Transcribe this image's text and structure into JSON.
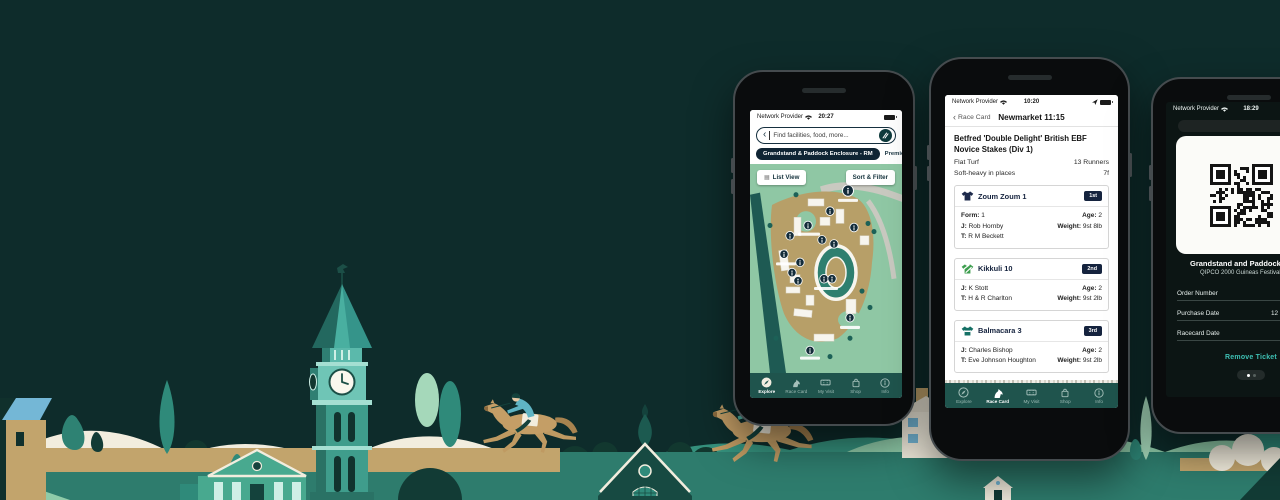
{
  "colors": {
    "sky": "#0E2C2B",
    "nav_bar_teal": "#1F544D",
    "accent_navy": "#15233E",
    "map_green": "#8FC7A4",
    "remove_link_teal": "#3EC0B4",
    "illustration_tan": "#C2A46C",
    "illustration_light_green": "#8FCBA9"
  },
  "nav_labels": [
    "Explore",
    "Race Card",
    "My Visit",
    "Shop",
    "Info"
  ],
  "explore_phone": {
    "carrier": "Network Provider",
    "time": "20:27",
    "search_placeholder": "Find facilities, food, more...",
    "chip_primary": "Grandstand & Paddock Enclosure - RM",
    "chip_secondary": "Premier Enclos",
    "list_view": "List View",
    "sort_filter": "Sort & Filter"
  },
  "racecard_phone": {
    "carrier": "Network Provider",
    "time": "10:20",
    "back": "Race Card",
    "heading": "Newmarket 11:15",
    "race_name": "Betfred 'Double Delight' British EBF Novice Stakes (Div 1)",
    "surface": "Flat Turf",
    "runners": "13 Runners",
    "going": "Soft-heavy in places",
    "distance": "7f",
    "horses": [
      {
        "name": "Zoum Zoum 1",
        "position": "1st",
        "left": [
          [
            "Form:",
            "1"
          ],
          [
            "J:",
            "Rob Hornby"
          ],
          [
            "T:",
            "R M Beckett"
          ]
        ],
        "right": [
          [
            "Age:",
            "2"
          ],
          [
            "Weight:",
            "9st 8lb"
          ]
        ]
      },
      {
        "name": "Kikkuli 10",
        "position": "2nd",
        "left": [
          [
            "J:",
            "K Stott"
          ],
          [
            "T:",
            "H & R Charlton"
          ]
        ],
        "right": [
          [
            "Age:",
            "2"
          ],
          [
            "Weight:",
            "9st 2lb"
          ]
        ]
      },
      {
        "name": "Balmacara 3",
        "position": "3rd",
        "left": [
          [
            "J:",
            "Charles Bishop"
          ],
          [
            "T:",
            "Eve Johnson Houghton"
          ]
        ],
        "right": [
          [
            "Age:",
            "2"
          ],
          [
            "Weight:",
            "9st 2lb"
          ]
        ]
      }
    ]
  },
  "ticket_phone": {
    "carrier": "Network Provider",
    "time": "18:29",
    "ticket_title": "Grandstand and Paddock - Adu",
    "ticket_subtitle": "QIPCO 2000 Guineas Festival",
    "fields": [
      {
        "label": "Order Number",
        "value": ""
      },
      {
        "label": "Purchase Date",
        "value": "12 De"
      },
      {
        "label": "Racecard Date",
        "value": ""
      }
    ],
    "remove": "Remove Ticket"
  }
}
